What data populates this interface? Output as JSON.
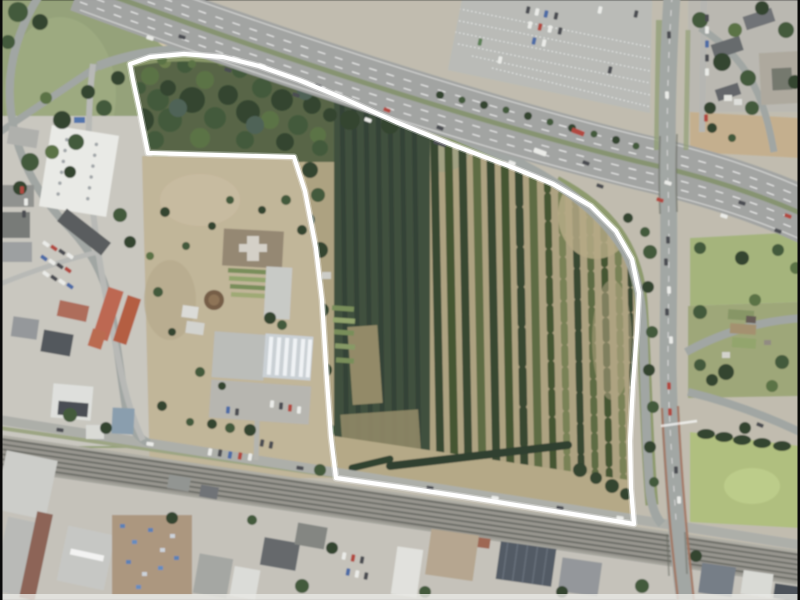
{
  "image": {
    "kind": "aerial-orthophoto",
    "alt": "Aerial photograph of a former tree-nursery site outlined with a white boundary, bounded by a motorway to the north, a bridged cross road to the east, a railway corridor and street to the south, and commercial buildings, a garden centre and housing to the west"
  },
  "overlay": {
    "boundary": {
      "color": "#ffffff",
      "stroke_width": 4.2,
      "points": "130,64 150,57 184,54 223,57 259,66 299,80 345,99 396,122 450,144 509,166 553,184 591,206 616,231 632,259 639,293 637,331 633,383 630,441 631,489 634,524 560,512 466,497 400,487 336,478 331,437 327,381 322,300 316,248 305,191 294,157 148,153 139,108 133,80"
    }
  },
  "features": [
    {
      "name": "motorway"
    },
    {
      "name": "slip-roads"
    },
    {
      "name": "cross-road-bridge"
    },
    {
      "name": "railway-corridor"
    },
    {
      "name": "parking-lot"
    },
    {
      "name": "warehouse"
    },
    {
      "name": "garden-centre"
    },
    {
      "name": "tree-nursery-rows"
    },
    {
      "name": "scrubland"
    },
    {
      "name": "allotments"
    },
    {
      "name": "meadow"
    },
    {
      "name": "industrial-halls"
    },
    {
      "name": "residential-blocks"
    }
  ],
  "palette": {
    "asphalt": "#9b9e9b",
    "soil": "#a99b73",
    "scrub": "#beb08e",
    "conifer_block": "#31452f",
    "tree_green": "#33502b",
    "grass": "#8d9c6b",
    "meadow": "#a9bc6e",
    "railway": "#8f8e85",
    "warehouse_roof": "#e8e9e4",
    "red_roof": "#c25c40",
    "sand": "#d9c9a2",
    "boundary_line": "#ffffff"
  }
}
